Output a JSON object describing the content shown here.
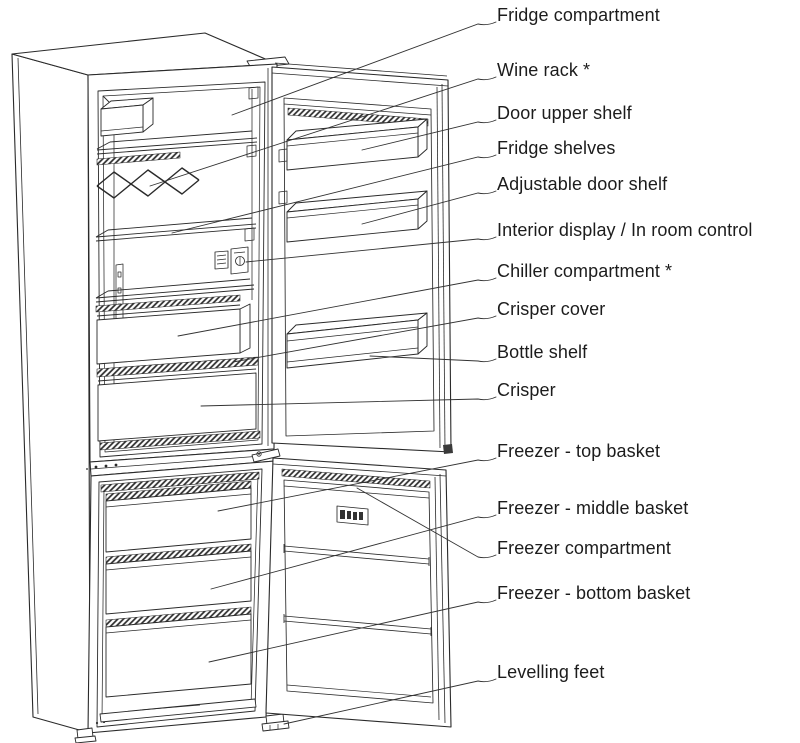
{
  "diagram": {
    "subject": "fridge-freezer-parts-diagram",
    "colors": {
      "line": "#2a2a2a",
      "text": "#1c1c1c",
      "background": "#ffffff"
    },
    "freezer_display": {
      "icon": "segment-display-icon"
    }
  },
  "labels": [
    {
      "id": "fridge-compartment",
      "text": "Fridge compartment"
    },
    {
      "id": "wine-rack",
      "text": "Wine rack *"
    },
    {
      "id": "door-upper-shelf",
      "text": "Door upper shelf"
    },
    {
      "id": "fridge-shelves",
      "text": "Fridge shelves"
    },
    {
      "id": "adjustable-door-shelf",
      "text": "Adjustable door shelf"
    },
    {
      "id": "interior-display",
      "text": "Interior display / In room control"
    },
    {
      "id": "chiller-compartment",
      "text": "Chiller compartment *"
    },
    {
      "id": "crisper-cover",
      "text": "Crisper cover"
    },
    {
      "id": "bottle-shelf",
      "text": "Bottle shelf"
    },
    {
      "id": "crisper",
      "text": "Crisper"
    },
    {
      "id": "freezer-top-basket",
      "text": "Freezer - top basket"
    },
    {
      "id": "freezer-middle-basket",
      "text": "Freezer - middle basket"
    },
    {
      "id": "freezer-compartment",
      "text": "Freezer compartment"
    },
    {
      "id": "freezer-bottom-basket",
      "text": "Freezer - bottom basket"
    },
    {
      "id": "levelling-feet",
      "text": "Levelling feet"
    }
  ]
}
